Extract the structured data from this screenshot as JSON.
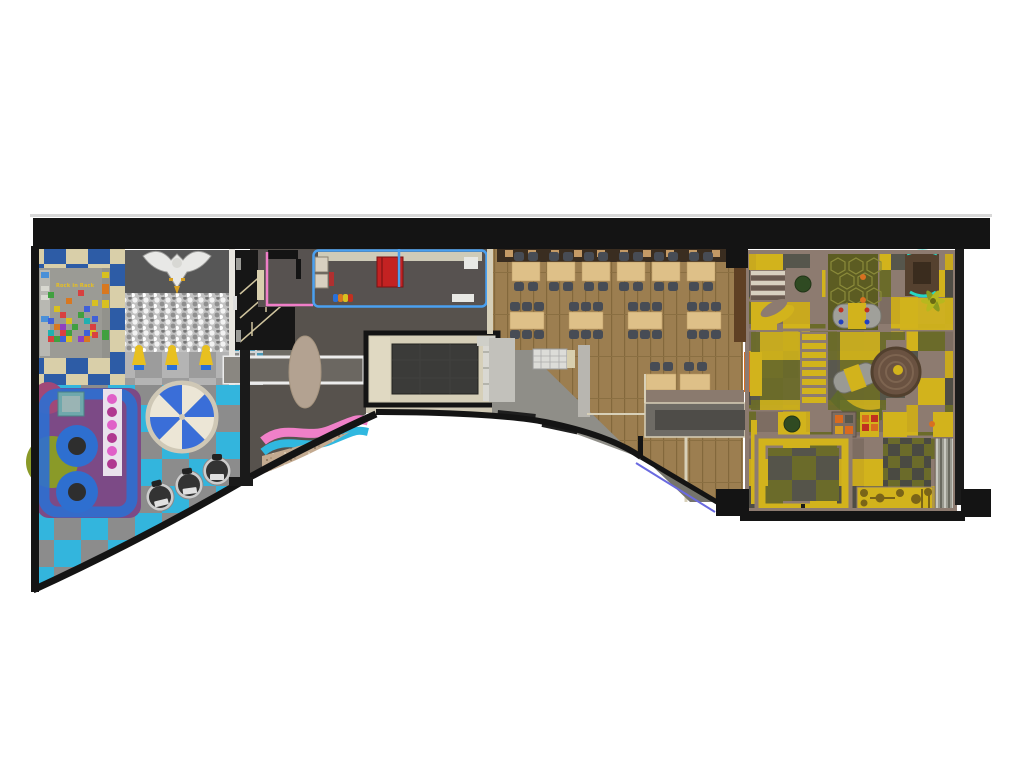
{
  "labels": {
    "climb_wall_sign": "Rock in Rack"
  },
  "palette": {
    "wall_black": "#141414",
    "top_line": "#d8d8d8",
    "checker_blue": "#33b5dd",
    "checker_gray": "#8c8c8c",
    "tile_blue": "#2d5ca6",
    "tile_beige": "#d9cfa9",
    "floor_gray": "#57524d",
    "room_dark": "#575250",
    "wood": "#9c7e50",
    "wood_line": "#83683c",
    "table_tan": "#dec088",
    "chair_slate": "#474c55",
    "counter_brown": "#3a2d20",
    "trim_blue": "#4aa0f0",
    "trim_pink": "#f07ec8",
    "wave_pink": "#f080c8",
    "wave_blue": "#30b8e0",
    "carpet_tan": "#c3aa90",
    "stage_beige": "#d6cfb8",
    "screen_dark": "#3b3b39",
    "toddler_purple": "#7c4a86",
    "toddler_olive": "#8a9a28",
    "ring_blue": "#2e6fd0",
    "dot_pink": "#d84ab8",
    "carousel_blue": "#3a6ed8",
    "carousel_cream": "#ece6d6",
    "play_taupe": "#8d7b70",
    "play_yellow": "#d2b31c",
    "play_olive": "#6b6b2a",
    "play_gray": "#56564c",
    "play_brown": "#6a5241",
    "teal": "#25d8c4",
    "glass_blue": "#6a6ae0",
    "figure_yellow": "#e8c020",
    "silver": "#cccccc",
    "kitchen_gray": "#8f8e88",
    "steel": "#dcdcd8",
    "ballpit_base": "#c2c2c2"
  }
}
